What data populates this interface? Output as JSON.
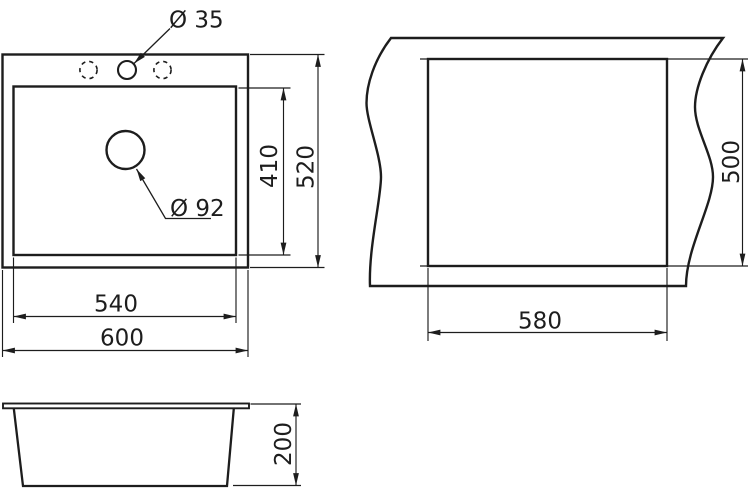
{
  "colors": {
    "line": "#1d1d1d",
    "background": "#ffffff"
  },
  "top_view": {
    "outer_width": "600",
    "inner_width": "540",
    "outer_depth": "520",
    "inner_depth": "410",
    "faucet_hole_diameter": "Ø 35",
    "drain_hole_diameter": "Ø 92"
  },
  "cutout_view": {
    "width": "580",
    "height": "500"
  },
  "side_view": {
    "height": "200"
  }
}
